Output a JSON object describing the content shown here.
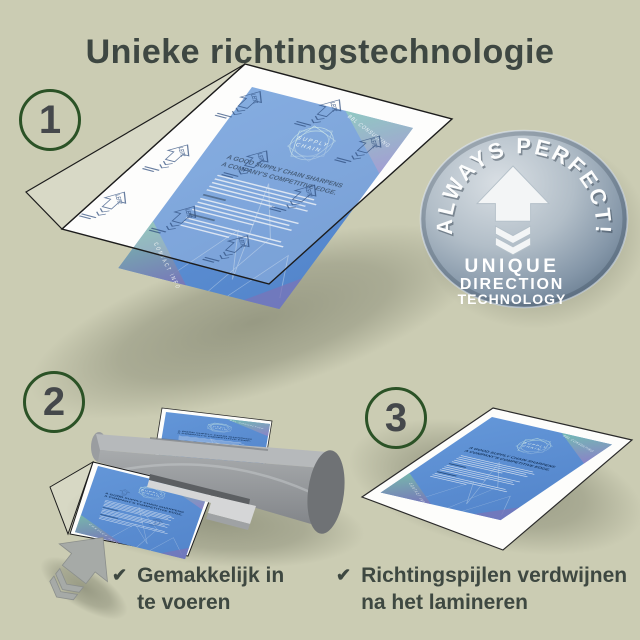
{
  "page": {
    "title": "Unieke richtingstechnologie",
    "background_color": "#cbccb3",
    "title_color": "#3e4742",
    "accent_green": "#2b5226"
  },
  "steps": {
    "one": "1",
    "two": "2",
    "three": "3"
  },
  "badge": {
    "arc_text": "ALWAYS PERFECT!",
    "line1": "UNIQUE",
    "line2": "DIRECTION",
    "line3": "TECHNOLOGY",
    "face_color": "#8496a8",
    "arrow_color": "#f3f5f6"
  },
  "brochure": {
    "company": "BBL CONSULTING",
    "logo_top": "SUPPLY",
    "logo_bottom": "CHAIN",
    "headline1": "A GOOD SUPPLY CHAIN SHARPENS",
    "headline2": "A COMPANY'S COMPETITIVE EDGE.",
    "footer": "CONTACT INFO",
    "paper_blue": "#5a8fd3"
  },
  "pouch": {
    "brand": "LEITZ"
  },
  "checklist": [
    {
      "mark": "✔",
      "line1": "Gemakkelijk in",
      "line2": "te voeren"
    },
    {
      "mark": "✔",
      "line1": "Richtingspijlen verdwijnen",
      "line2": "na het lamineren"
    }
  ]
}
